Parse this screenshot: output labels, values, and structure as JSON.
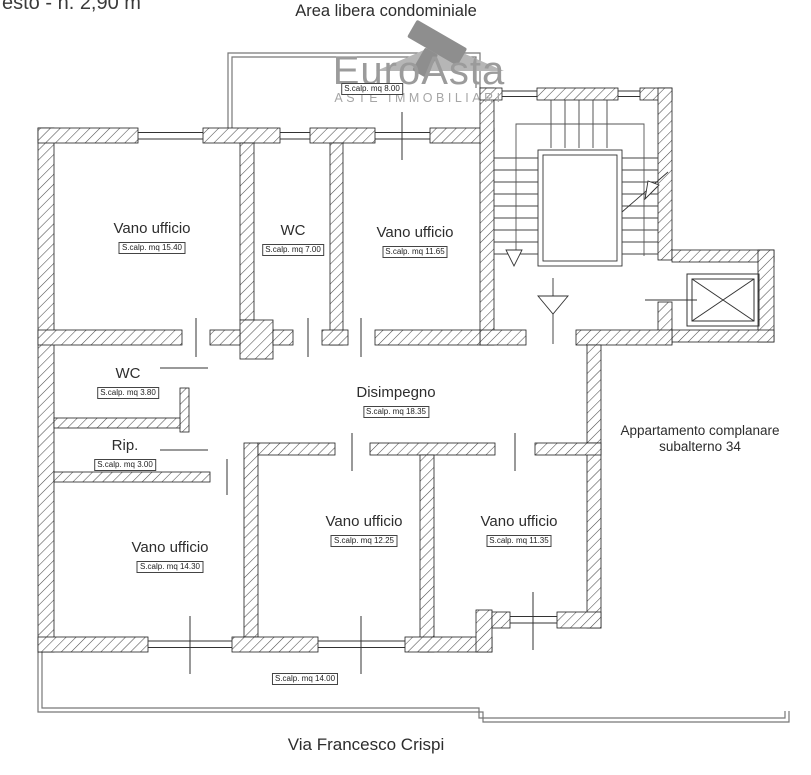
{
  "page": {
    "top_left_note": "esto - h. 2,90 m",
    "top_title": "Area libera condominiale",
    "street_label": "Via Francesco Crispi",
    "side_note_line1": "Appartamento complanare",
    "side_note_line2": "subalterno 34"
  },
  "logo": {
    "name": "EuroAsta",
    "tagline": "ASTE IMMOBILIARI",
    "icon": "gavel-icon",
    "text_color": "#9b9b9b",
    "tagline_color": "#a6a6a6",
    "icon_dark_color": "#8e8e8e",
    "icon_light_color": "#b6b6b6"
  },
  "rooms": [
    {
      "id": "vano-ufficio-1",
      "label": "Vano ufficio",
      "area": "S.calp. mq 15.40"
    },
    {
      "id": "wc-1",
      "label": "WC",
      "area": "S.calp. mq 7.00"
    },
    {
      "id": "vano-ufficio-2",
      "label": "Vano ufficio",
      "area": "S.calp. mq 11.65"
    },
    {
      "id": "wc-2",
      "label": "WC",
      "area": "S.calp. mq 3.80"
    },
    {
      "id": "rip",
      "label": "Rip.",
      "area": "S.calp. mq 3.00"
    },
    {
      "id": "disimpegno",
      "label": "Disimpegno",
      "area": "S.calp. mq 18.35"
    },
    {
      "id": "vano-ufficio-3",
      "label": "Vano ufficio",
      "area": "S.calp. mq 14.30"
    },
    {
      "id": "vano-ufficio-4",
      "label": "Vano ufficio",
      "area": "S.calp. mq 12.25"
    },
    {
      "id": "vano-ufficio-5",
      "label": "Vano ufficio",
      "area": "S.calp. mq 11.35"
    }
  ],
  "outdoor_areas": [
    {
      "id": "area-libera-condominiale",
      "area": "S.calp. mq 8.00"
    },
    {
      "id": "balcone",
      "area": "S.calp. mq 14.00"
    }
  ],
  "icons": {
    "logo": "gavel-icon",
    "stair_down": "down-arrow-icon",
    "stair_up": "up-arrow-icon",
    "elevator": "elevator-x-icon"
  },
  "colors": {
    "wall_hatch": "#4d4d4d",
    "linework": "#333333",
    "outline_gray": "#777777",
    "text": "#2d2d2d"
  }
}
